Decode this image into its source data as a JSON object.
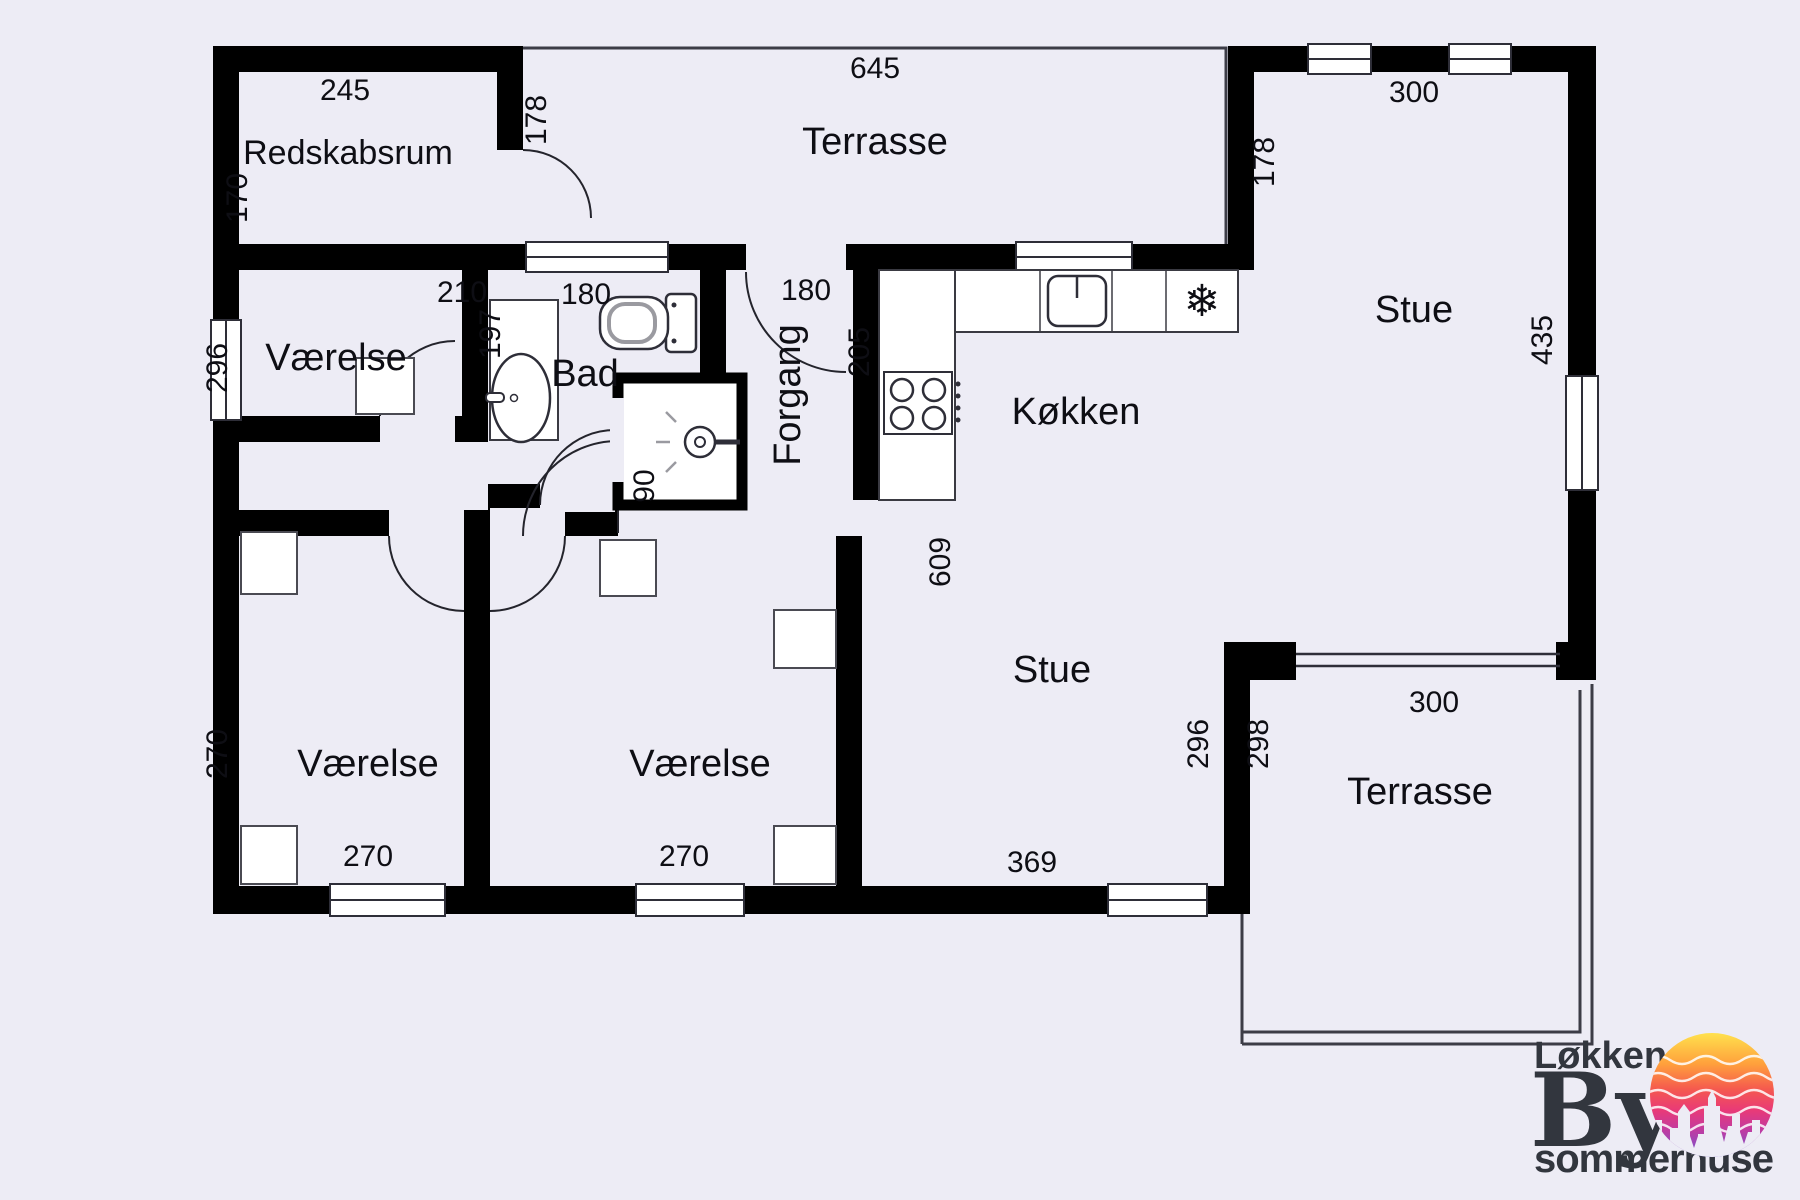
{
  "floorplan": {
    "rooms": {
      "redskabsrum": "Redskabsrum",
      "terrasse_top": "Terrasse",
      "stue_top": "Stue",
      "koekken": "Køkken",
      "bad": "Bad",
      "forgang": "Forgang",
      "vaerelse1": "Værelse",
      "vaerelse2": "Værelse",
      "vaerelse3": "Værelse",
      "stue_main": "Stue",
      "terrasse_bottom": "Terrasse"
    },
    "dims": {
      "redskabsrum_w": "245",
      "redskabsrum_h": "170",
      "redskabsrum_door": "178",
      "terrasse_top_w": "645",
      "vaerelse1_w": "210",
      "vaerelse1_h": "296",
      "bad_window": "180",
      "bad_w": "197",
      "entry_door": "180",
      "koekken_h": "205",
      "stue_top_w": "300",
      "stue_top_wall": "178",
      "stue_right_h": "435",
      "corridor_door": "90",
      "stue_h": "609",
      "stue_wall_in": "296",
      "stue_wall_out": "298",
      "terrasse_bottom_w": "300",
      "vaerelse3_h": "270",
      "vaerelse3_w": "270",
      "vaerelse2_w": "270",
      "stue_w": "369"
    },
    "icons": {
      "freezer": "❄"
    }
  },
  "logo": {
    "town": "Løkken",
    "mid": "By",
    "sub": "sommerhuse"
  },
  "colors": {
    "background": "#edecf5",
    "wall": "#000000",
    "thin_line": "#3c3c46",
    "fixture_stroke": "#333333",
    "logo_text": "#32363e",
    "sun_gradient": [
      "#ffe14d",
      "#ffa03c",
      "#f55a4e",
      "#e93a77",
      "#c13ba0",
      "#6e55d4"
    ]
  }
}
